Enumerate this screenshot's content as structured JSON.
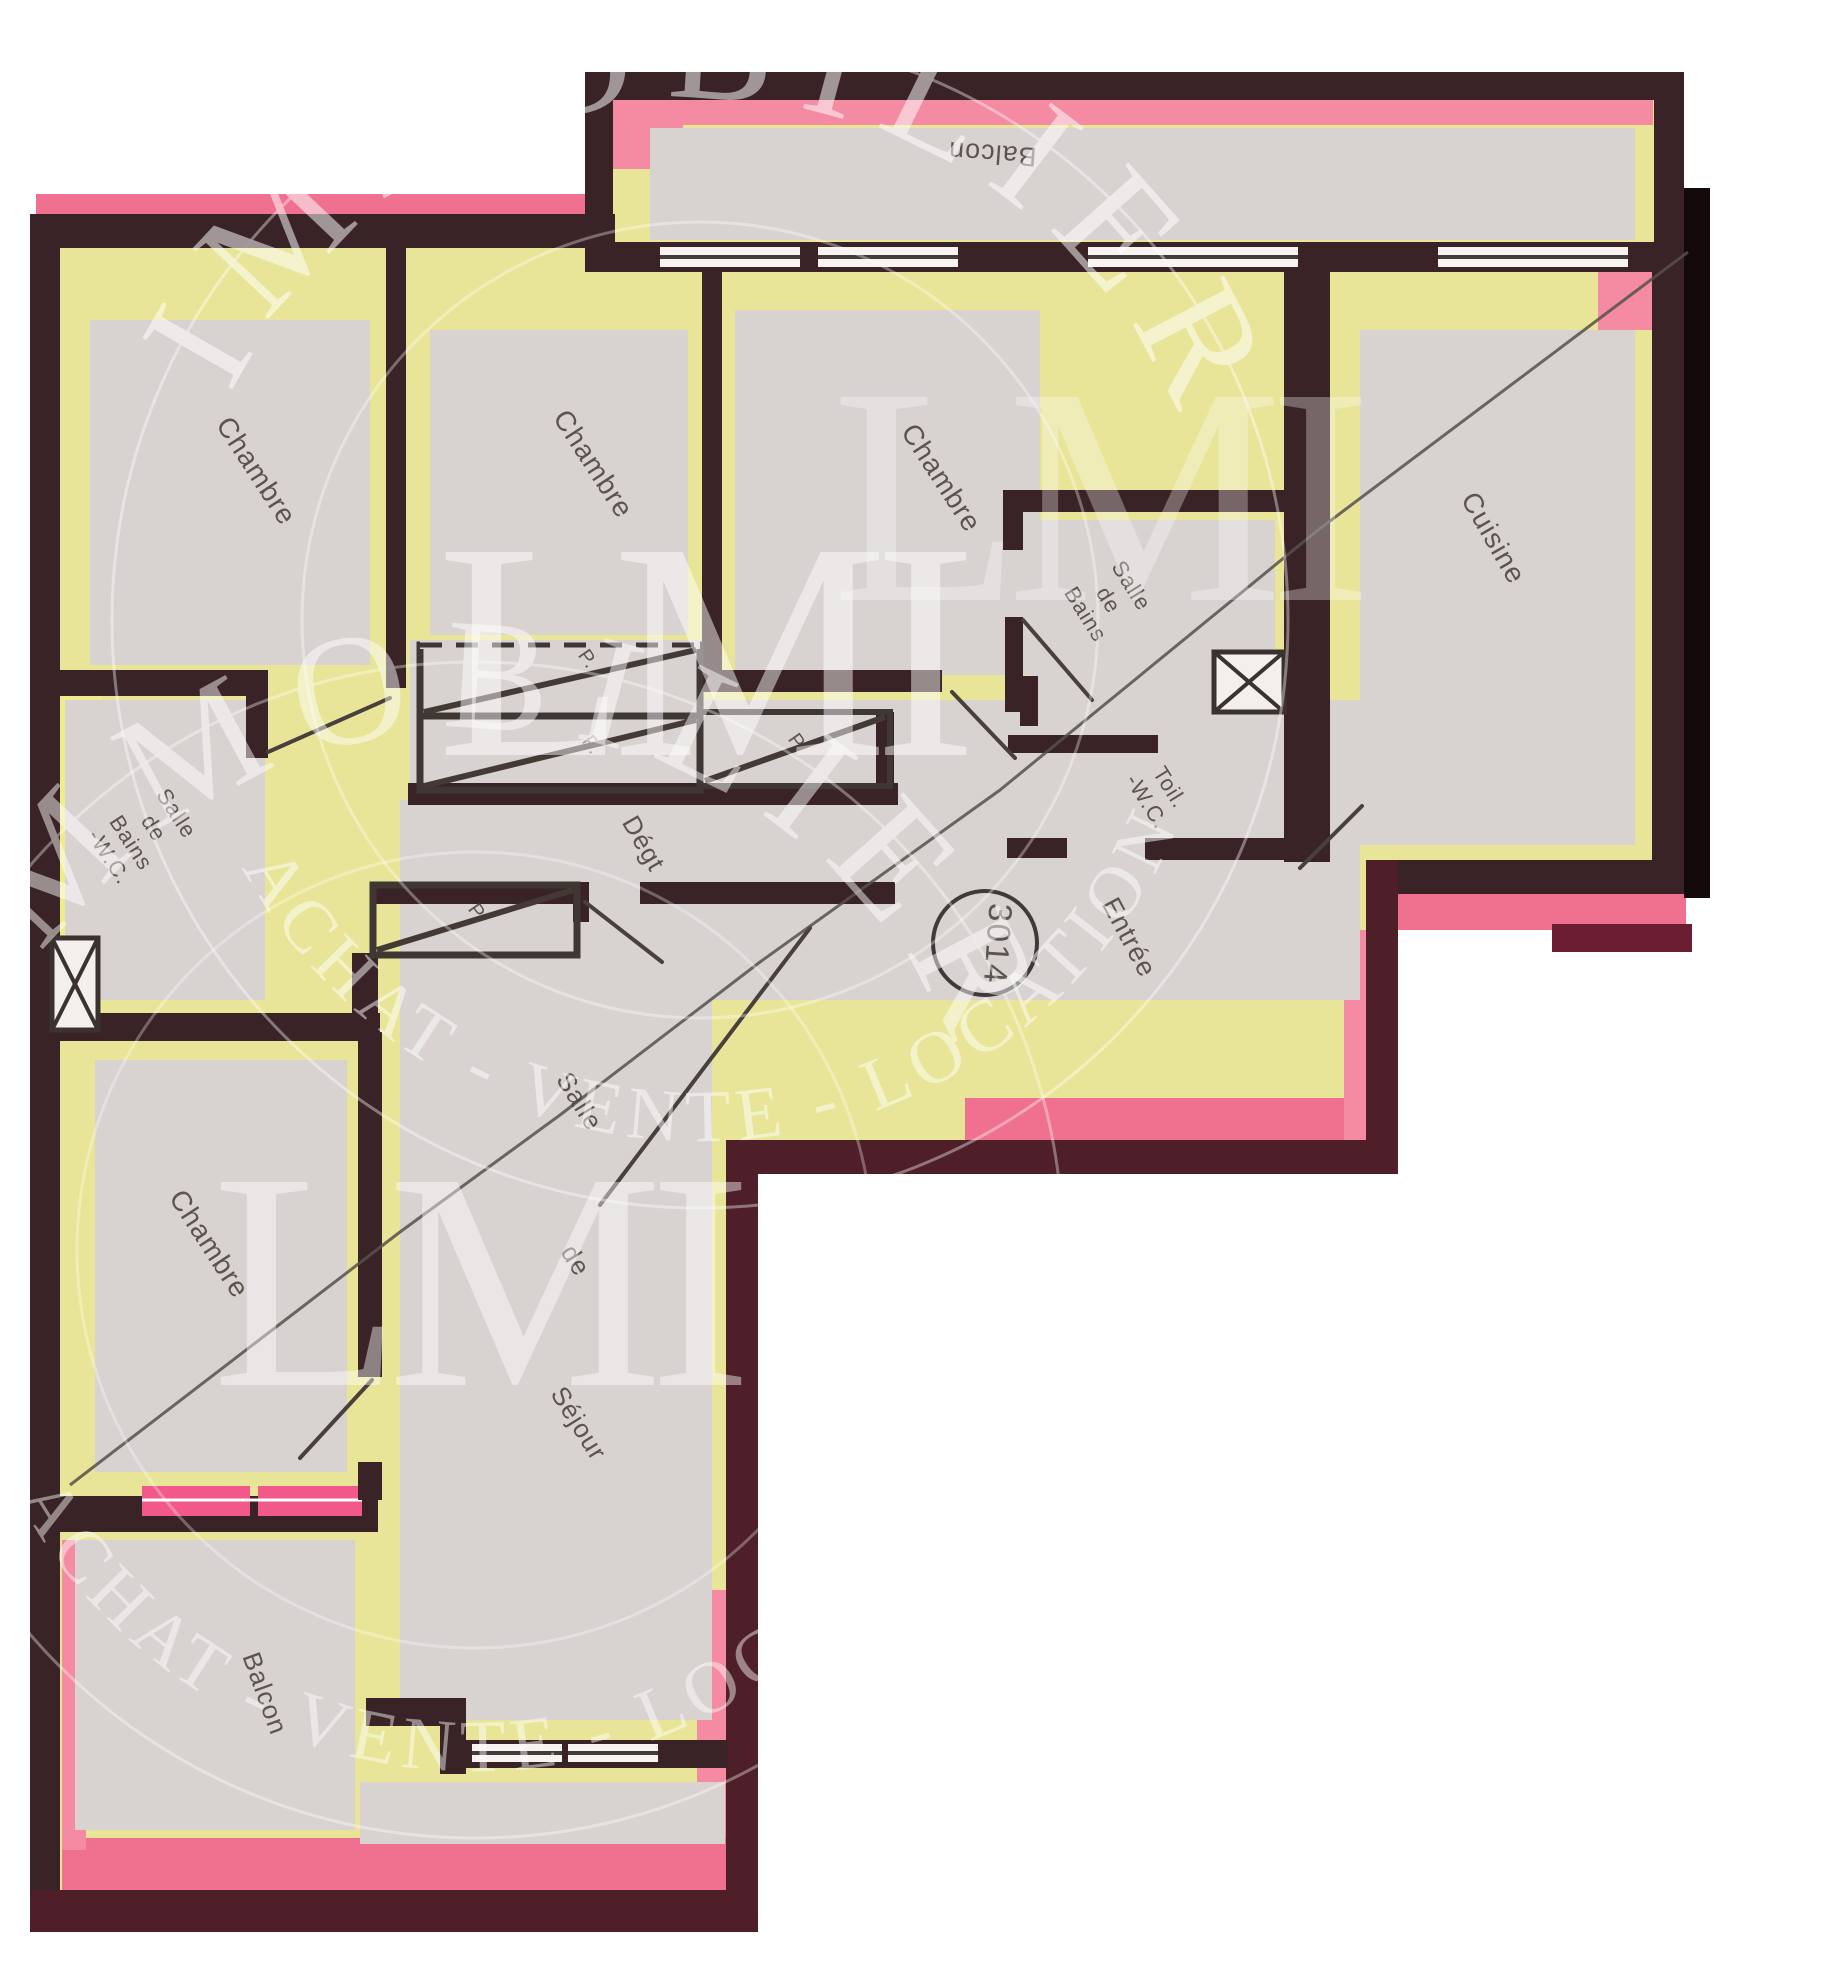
{
  "document": {
    "kind": "apartment floor plan (scanned, hand-highlighted)"
  },
  "unit": {
    "number": "3014"
  },
  "rooms": {
    "balcony_top": {
      "label": "Balcon"
    },
    "chambre_1": {
      "label": "Chambre"
    },
    "chambre_2": {
      "label": "Chambre"
    },
    "chambre_3": {
      "label": "Chambre"
    },
    "cuisine": {
      "label": "Cuisine"
    },
    "salle_de_bains_center": {
      "line1": "Salle",
      "line2": "de",
      "line3": "Bains"
    },
    "toilettes": {
      "line1": "Toil.",
      "line2": "-W.C."
    },
    "entree": {
      "label": "Entrée"
    },
    "degagement": {
      "label": "Dégt"
    },
    "sejour": {
      "word1": "Salle",
      "word2": "de",
      "word3": "Séjour"
    },
    "salle_de_bains_left": {
      "line1": "Salle",
      "line2": "de",
      "line3": "Bains",
      "line4": "-W.C."
    },
    "chambre_4": {
      "label": "Chambre"
    },
    "balcony_bottom": {
      "label": "Balcon"
    }
  },
  "closets": {
    "p1": "P.",
    "p2": "P.",
    "p3": "P.",
    "p4": "P."
  },
  "watermark": {
    "arc_top": "IMMOBILIER",
    "monogram": "LMI",
    "arc_bottom": "ACHAT - VENTE - LOCATION"
  },
  "colors": {
    "wall": "#3a2326",
    "wallred": "#4e1f28",
    "pink": "#f0718f",
    "pinkbright": "#f2588a",
    "pinksoft": "#f48ba3",
    "yellow": "#e9e598",
    "yellowbright": "#efec8e",
    "floor": "#d8d3d1",
    "ink": "#4b433d",
    "crease": "#55504b",
    "shadow": "#140a0c",
    "wm": "#ffffff"
  }
}
